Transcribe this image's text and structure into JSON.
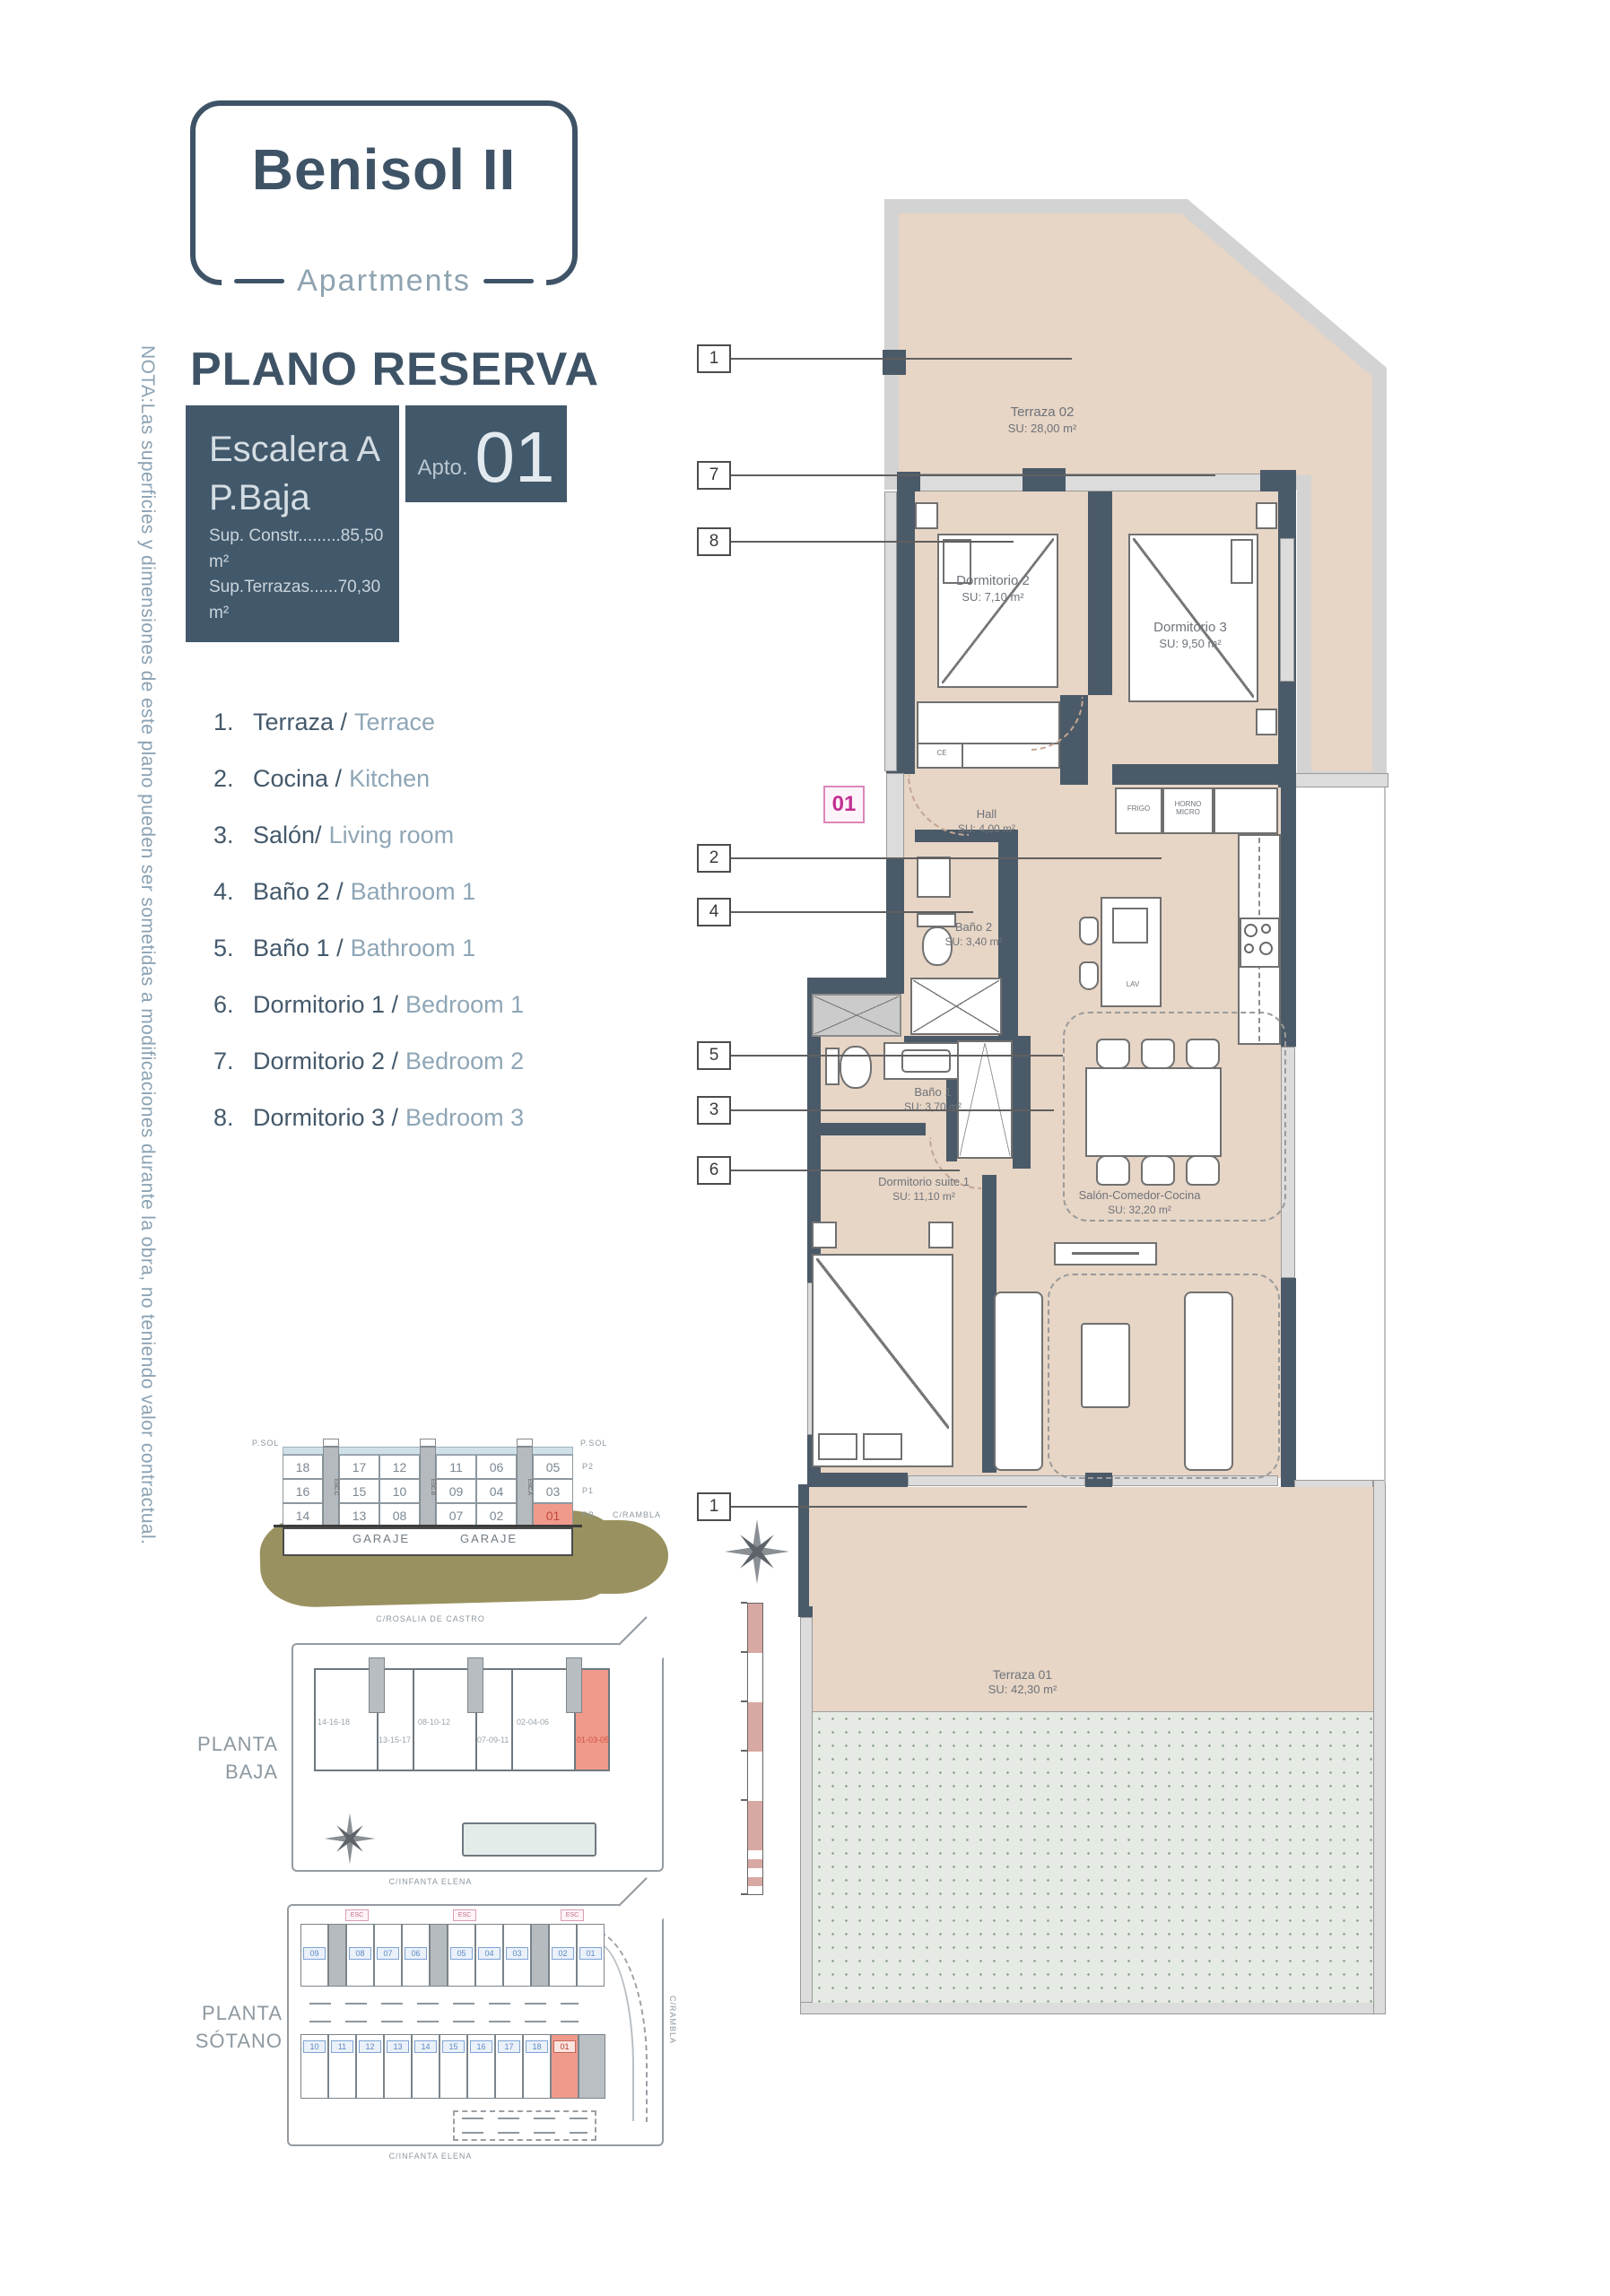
{
  "header": {
    "logo_title": "Benisol II",
    "logo_subtitle": "Apartments",
    "plan_title": "PLANO RESERVA",
    "unit": {
      "line1": "Escalera A",
      "line2": "P.Baja",
      "sup_constr": "Sup. Constr.........85,50 m²",
      "sup_terrazas": "Sup.Terrazas......70,30 m²",
      "apto_label": "Apto.",
      "apto_number": "01"
    }
  },
  "note_vertical": "NOTA:Las superficies y dimensiones de este plano pueden ser sometidas a modificaciones durante la obra, no teniendo valor contractual.",
  "legend": {
    "items": [
      {
        "num": "1.",
        "es": "Terraza /",
        "en": "Terrace"
      },
      {
        "num": "2.",
        "es": "Cocina /",
        "en": "Kitchen"
      },
      {
        "num": "3.",
        "es": "Salón/",
        "en": "Living room"
      },
      {
        "num": "4.",
        "es": "Baño 2 /",
        "en": "Bathroom 1"
      },
      {
        "num": "5.",
        "es": "Baño 1 /",
        "en": "Bathroom 1"
      },
      {
        "num": "6.",
        "es": "Dormitorio 1 /",
        "en": "Bedroom 1"
      },
      {
        "num": "7.",
        "es": "Dormitorio 2 /",
        "en": "Bedroom 2"
      },
      {
        "num": "8.",
        "es": "Dormitorio 3 /",
        "en": "Bedroom 3"
      }
    ]
  },
  "plan": {
    "badge": "01",
    "callouts": [
      "1",
      "7",
      "8",
      "2",
      "4",
      "5",
      "3",
      "6",
      "1"
    ],
    "rooms": {
      "terraza02": {
        "name": "Terraza 02",
        "area": "SU: 28,00 m²"
      },
      "dorm2": {
        "name": "Dormitorio 2",
        "area": "SU: 7,10 m²"
      },
      "dorm3": {
        "name": "Dormitorio 3",
        "area": "SU: 9,50 m²"
      },
      "hall": {
        "name": "Hall",
        "area": "SU: 4,00 m²"
      },
      "bano2": {
        "name": "Baño 2",
        "area": "SU: 3,40 m²"
      },
      "bano1": {
        "name": "Baño 1",
        "area": "SU: 3,70 m²"
      },
      "salon": {
        "name": "Salón-Comedor-Cocina",
        "area": "SU: 32,20 m²"
      },
      "suite": {
        "name": "Dormitorio suite 1",
        "area": "SU: 11,10 m²"
      },
      "terraza01": {
        "name": "Terraza 01",
        "area": "SU: 42,30 m²"
      }
    },
    "fixtures": {
      "frigo": "FRIGO",
      "horno": "HORNO MICRO",
      "lav": "LAV",
      "ce": "CE",
      "acs": "ACS",
      "lavadora": "Lavadora"
    }
  },
  "section": {
    "rows": [
      [
        "18",
        "17",
        "12",
        "11",
        "06",
        "05"
      ],
      [
        "16",
        "15",
        "10",
        "09",
        "04",
        "03"
      ],
      [
        "14",
        "13",
        "08",
        "07",
        "02",
        "01"
      ]
    ],
    "garaje": [
      "GARAJE",
      "GARAJE"
    ],
    "psol_left": "P.SOL",
    "psol_right": "P.SOL",
    "floors": [
      "P2",
      "P1",
      "PB"
    ],
    "street": "C/RAMBLA",
    "esc": [
      "ESC.C",
      "ESC.B",
      "ESC.A"
    ]
  },
  "planta_baja": {
    "title1": "PLANTA",
    "title2": "BAJA",
    "street_top": "C/ROSALIA DE CASTRO",
    "street_bottom": "C/INFANTA ELENA",
    "blocks": [
      "14-16-18",
      "13-15-17",
      "08-10-12",
      "07-09-11",
      "02-04-06",
      "01-03-05"
    ]
  },
  "planta_sotano": {
    "title1": "PLANTA",
    "title2": "SÓTANO",
    "street_bottom": "C/INFANTA ELENA",
    "street_right": "C/RAMBLA",
    "esc_badges": [
      "ESC",
      "ESC",
      "ESC"
    ],
    "top_row": [
      "09",
      "08",
      "07",
      "06",
      "05",
      "04",
      "03",
      "02",
      "01"
    ],
    "bottom_row": [
      "10",
      "11",
      "12",
      "13",
      "14",
      "15",
      "16",
      "17",
      "18"
    ],
    "highlight": "01"
  }
}
